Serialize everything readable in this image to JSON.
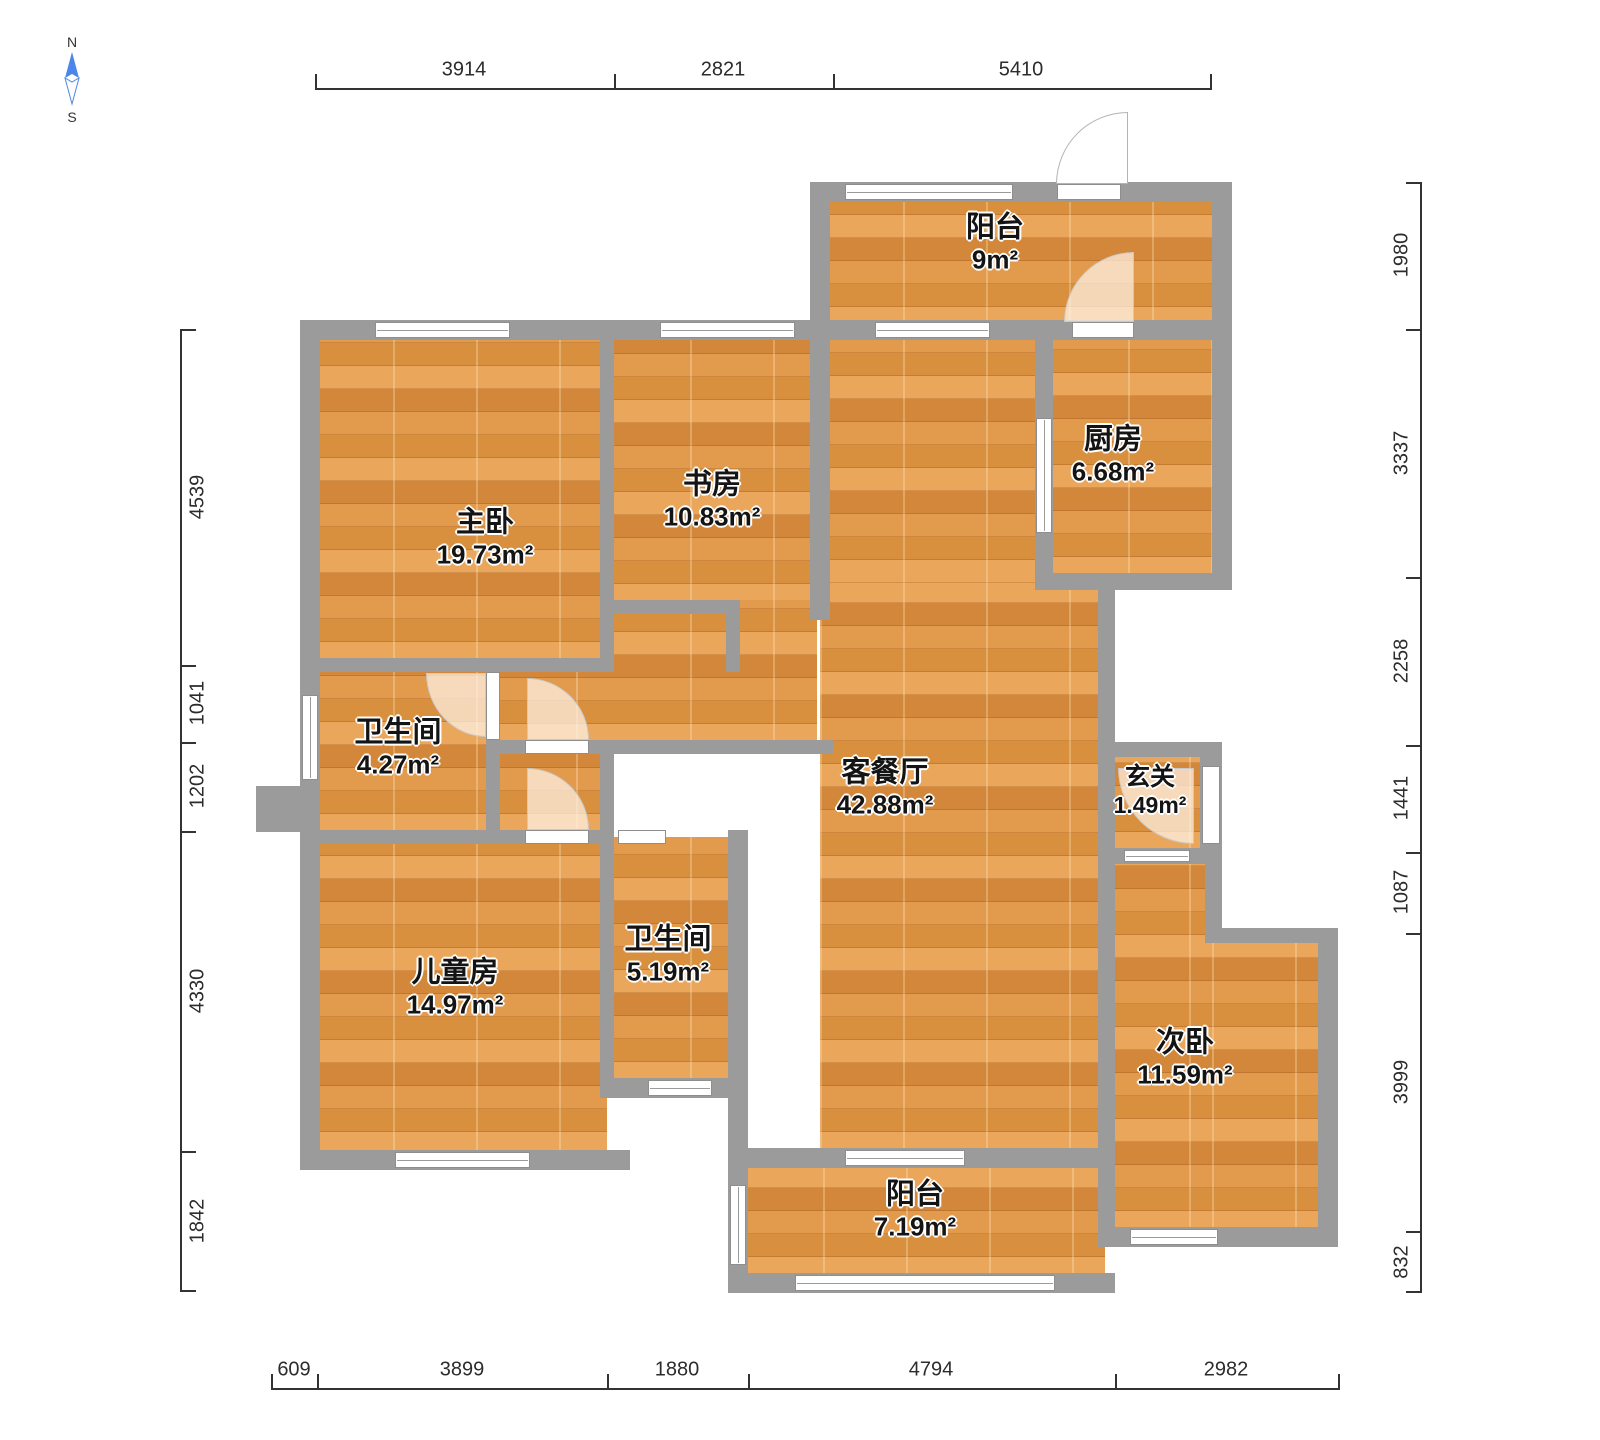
{
  "compass": {
    "north_label": "N",
    "south_label": "S"
  },
  "rooms": [
    {
      "id": "balcony-top",
      "label": "阳台",
      "area": "9m²"
    },
    {
      "id": "kitchen",
      "label": "厨房",
      "area": "6.68m²"
    },
    {
      "id": "master-bedroom",
      "label": "主卧",
      "area": "19.73m²"
    },
    {
      "id": "study",
      "label": "书房",
      "area": "10.83m²"
    },
    {
      "id": "bathroom-1",
      "label": "卫生间",
      "area": "4.27m²"
    },
    {
      "id": "living-dining",
      "label": "客餐厅",
      "area": "42.88m²"
    },
    {
      "id": "foyer",
      "label": "玄关",
      "area": "1.49m²"
    },
    {
      "id": "kids-room",
      "label": "儿童房",
      "area": "14.97m²"
    },
    {
      "id": "bathroom-2",
      "label": "卫生间",
      "area": "5.19m²"
    },
    {
      "id": "second-bedroom",
      "label": "次卧",
      "area": "11.59m²"
    },
    {
      "id": "balcony-bottom",
      "label": "阳台",
      "area": "7.19m²"
    }
  ],
  "dimensions": {
    "top": [
      "3914",
      "2821",
      "5410"
    ],
    "bottom": [
      "609",
      "3899",
      "1880",
      "4794",
      "2982"
    ],
    "left": [
      "4539",
      "1041",
      "1202",
      "4330",
      "1842"
    ],
    "right": [
      "1980",
      "3337",
      "2258",
      "1441",
      "1087",
      "3999",
      "832"
    ]
  },
  "colors": {
    "floor": "#df9a4f",
    "wall": "#9b9b9b",
    "compass_north": "#4b86ea",
    "dimension_text": "#2c2c2c"
  }
}
